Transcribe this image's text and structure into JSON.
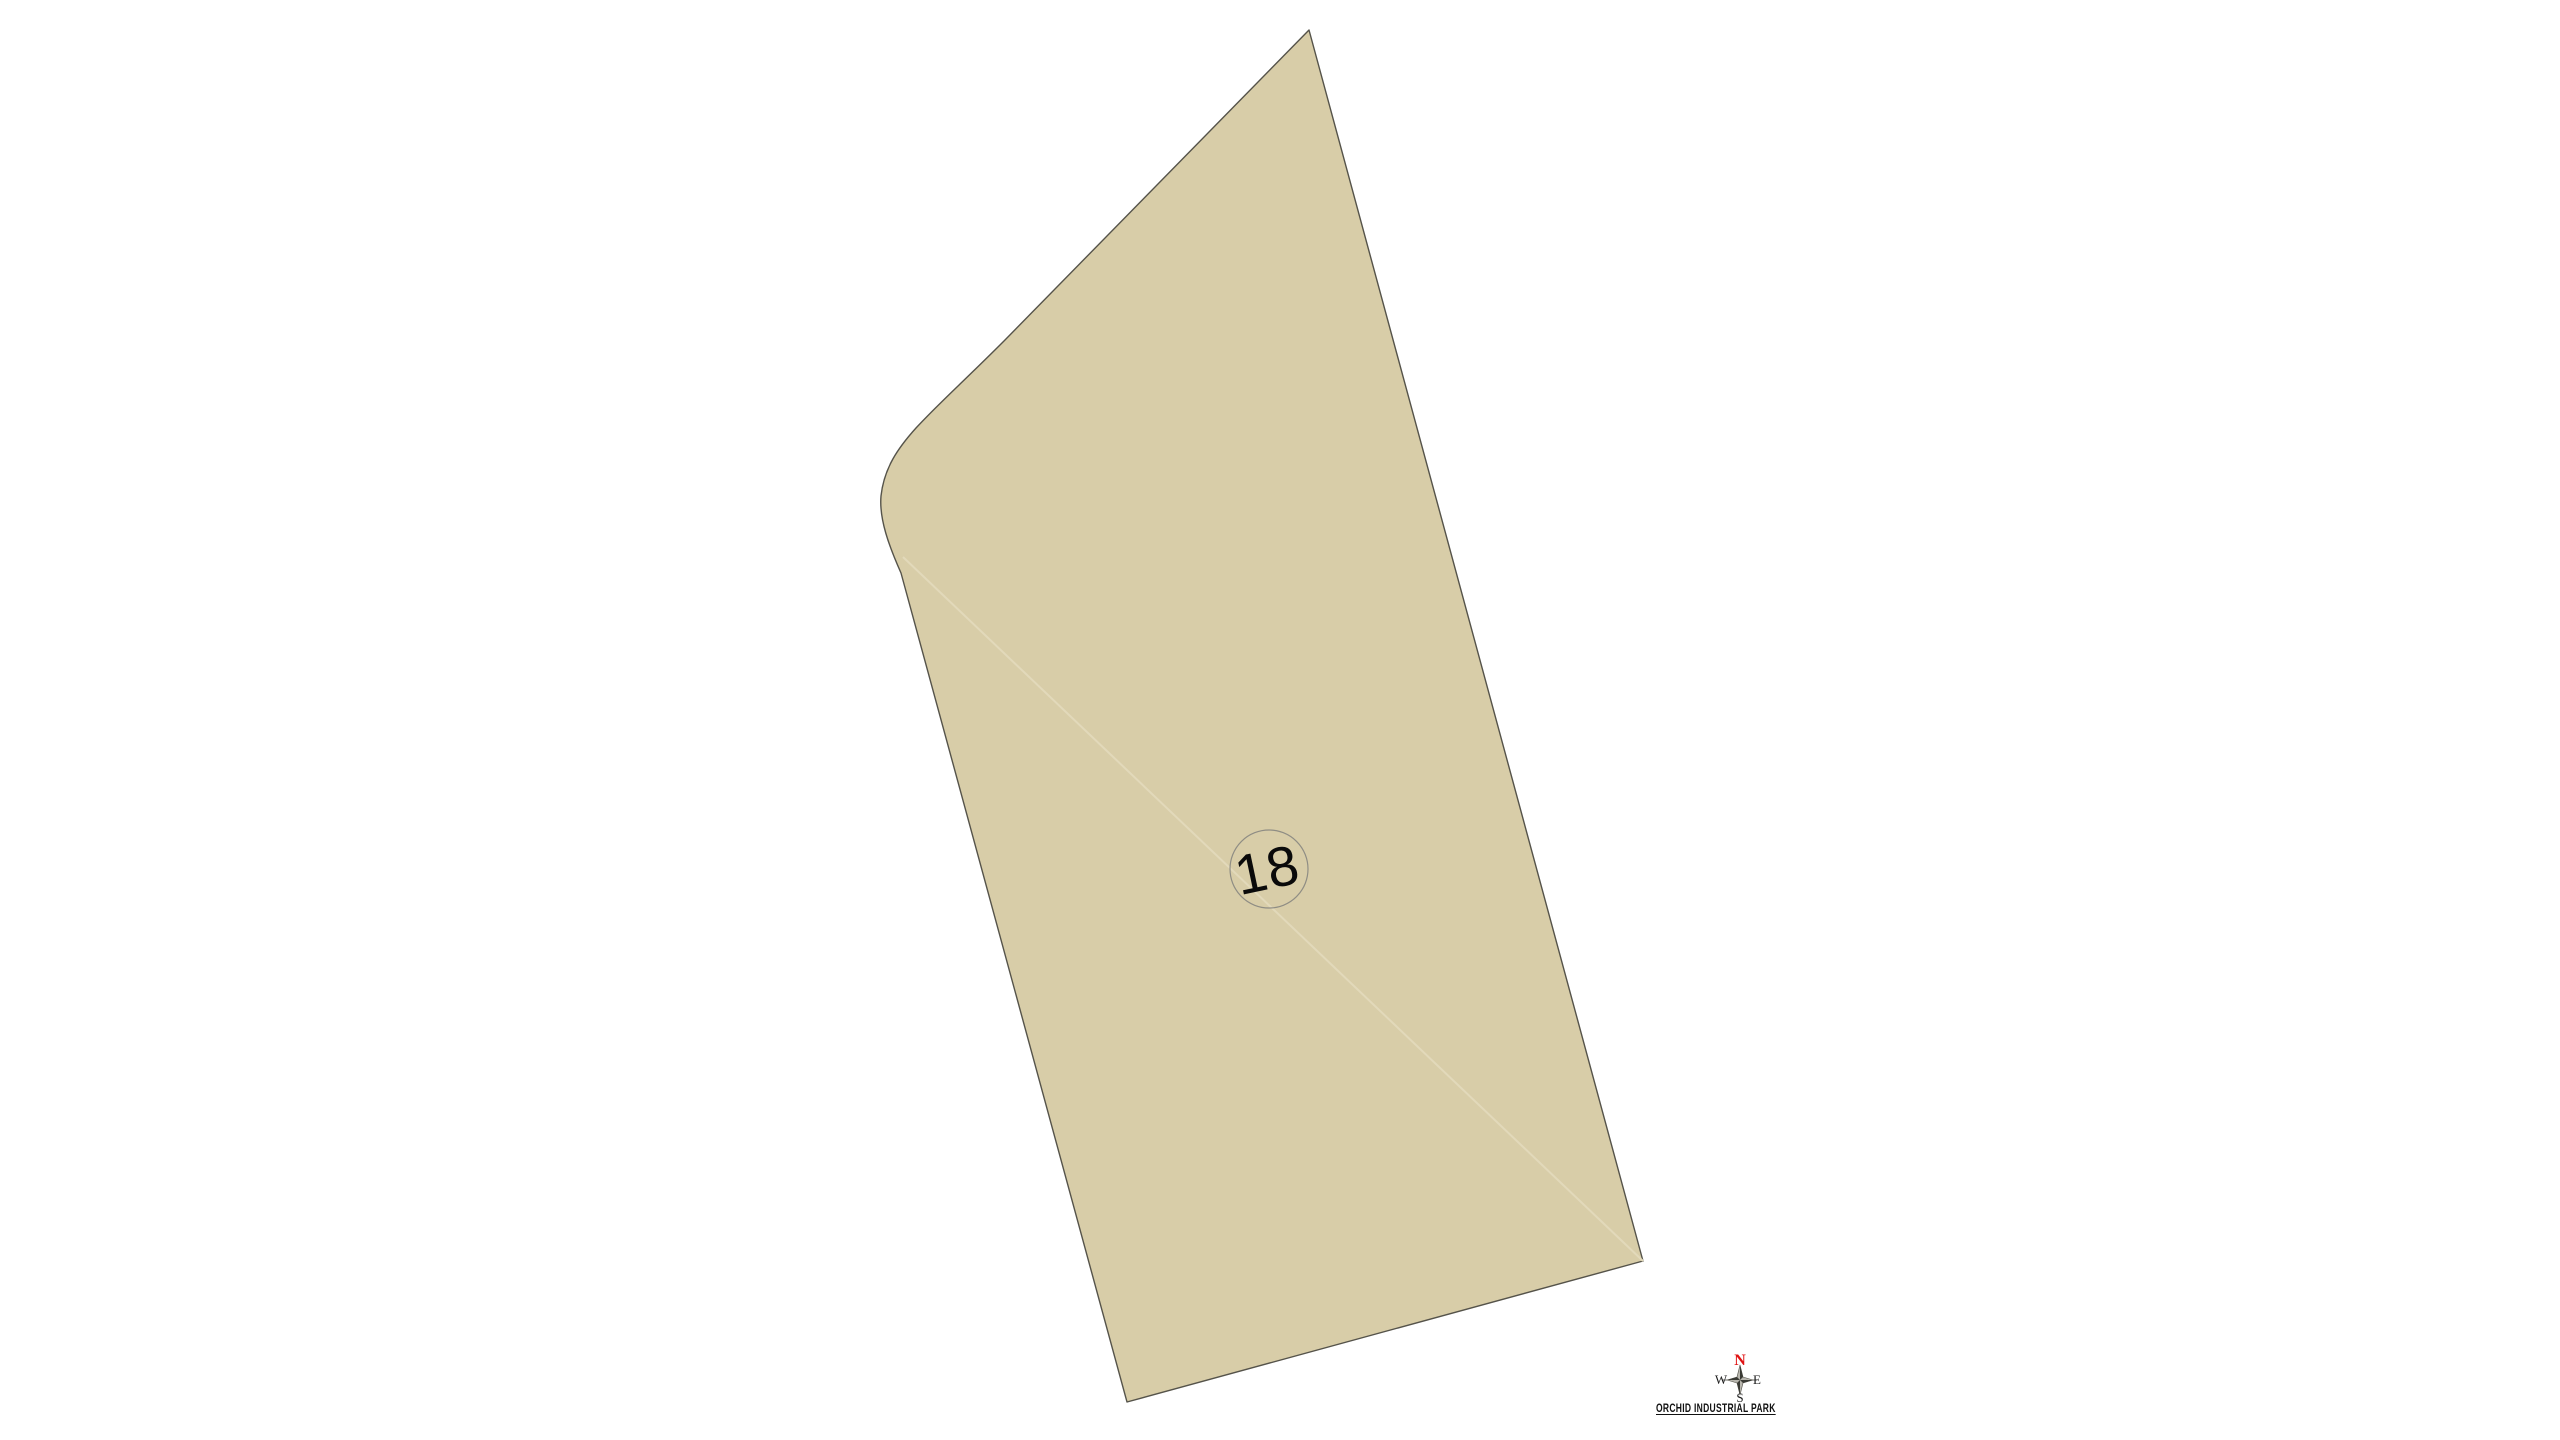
{
  "page": {
    "background_color": "#ffffff"
  },
  "map": {
    "parcel": {
      "number": "18",
      "fill_color": "#d8cda8",
      "outline_color": "#55534a",
      "label_circle_color": "#8f8d84"
    },
    "compass": {
      "north_label": "N",
      "east_label": "E",
      "south_label": "S",
      "west_label": "W",
      "north_color": "#e01212",
      "letter_color": "#1c1c1c"
    },
    "title": "ORCHID INDUSTRIAL PARK"
  }
}
